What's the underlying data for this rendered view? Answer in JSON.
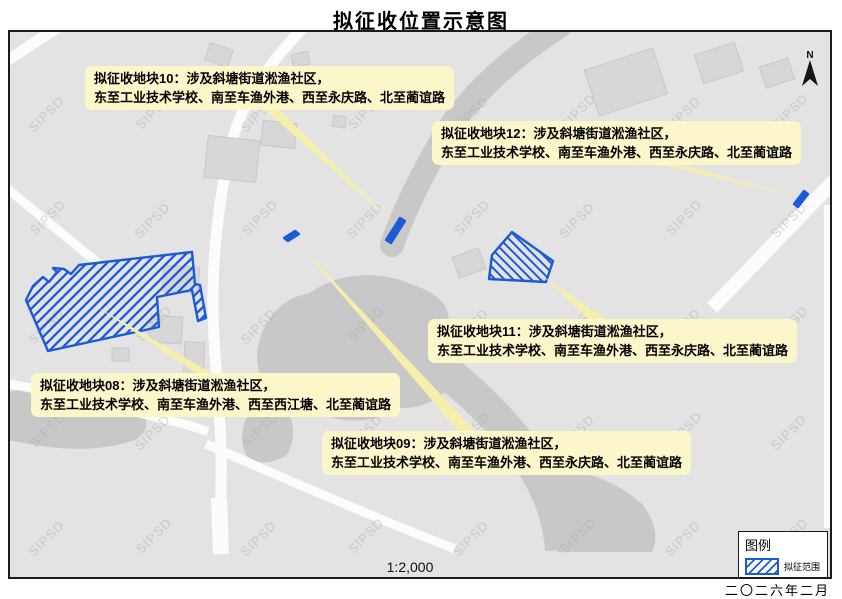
{
  "title": "拟征收位置示意图",
  "watermark": "SIPSD",
  "scale": "1:2,000",
  "date": "二〇二六年二月",
  "north": {
    "label": "N"
  },
  "legend": {
    "title": "图例",
    "item_label": "拟征范围"
  },
  "colors": {
    "parcel_blue": "#1c5bd6",
    "callout_yellow": "#fbf7ca",
    "leader_yellow": "#f6efac",
    "map_background": "#e3e3e3",
    "water_gray": "#c8c8c8",
    "road_white": "#fcfcfc"
  },
  "callouts": [
    {
      "id": "10",
      "line1": "拟征收地块10：涉及斜塘街道淞渔社区，",
      "line2": "东至工业技术学校、南至车渔外港、西至永庆路、北至蔺谊路"
    },
    {
      "id": "12",
      "line1": "拟征收地块12：涉及斜塘街道淞渔社区，",
      "line2": "东至工业技术学校、南至车渔外港、西至永庆路、北至蔺谊路"
    },
    {
      "id": "11",
      "line1": "拟征收地块11：涉及斜塘街道淞渔社区，",
      "line2": "东至工业技术学校、南至车渔外港、西至永庆路、北至蔺谊路"
    },
    {
      "id": "08",
      "line1": "拟征收地块08：涉及斜塘街道淞渔社区，",
      "line2": "东至工业技术学校、南至车渔外港、西至西江塘、北至蔺谊路"
    },
    {
      "id": "09",
      "line1": "拟征收地块09：涉及斜塘街道淞渔社区，",
      "line2": "东至工业技术学校、南至车渔外港、西至永庆路、北至蔺谊路"
    }
  ]
}
